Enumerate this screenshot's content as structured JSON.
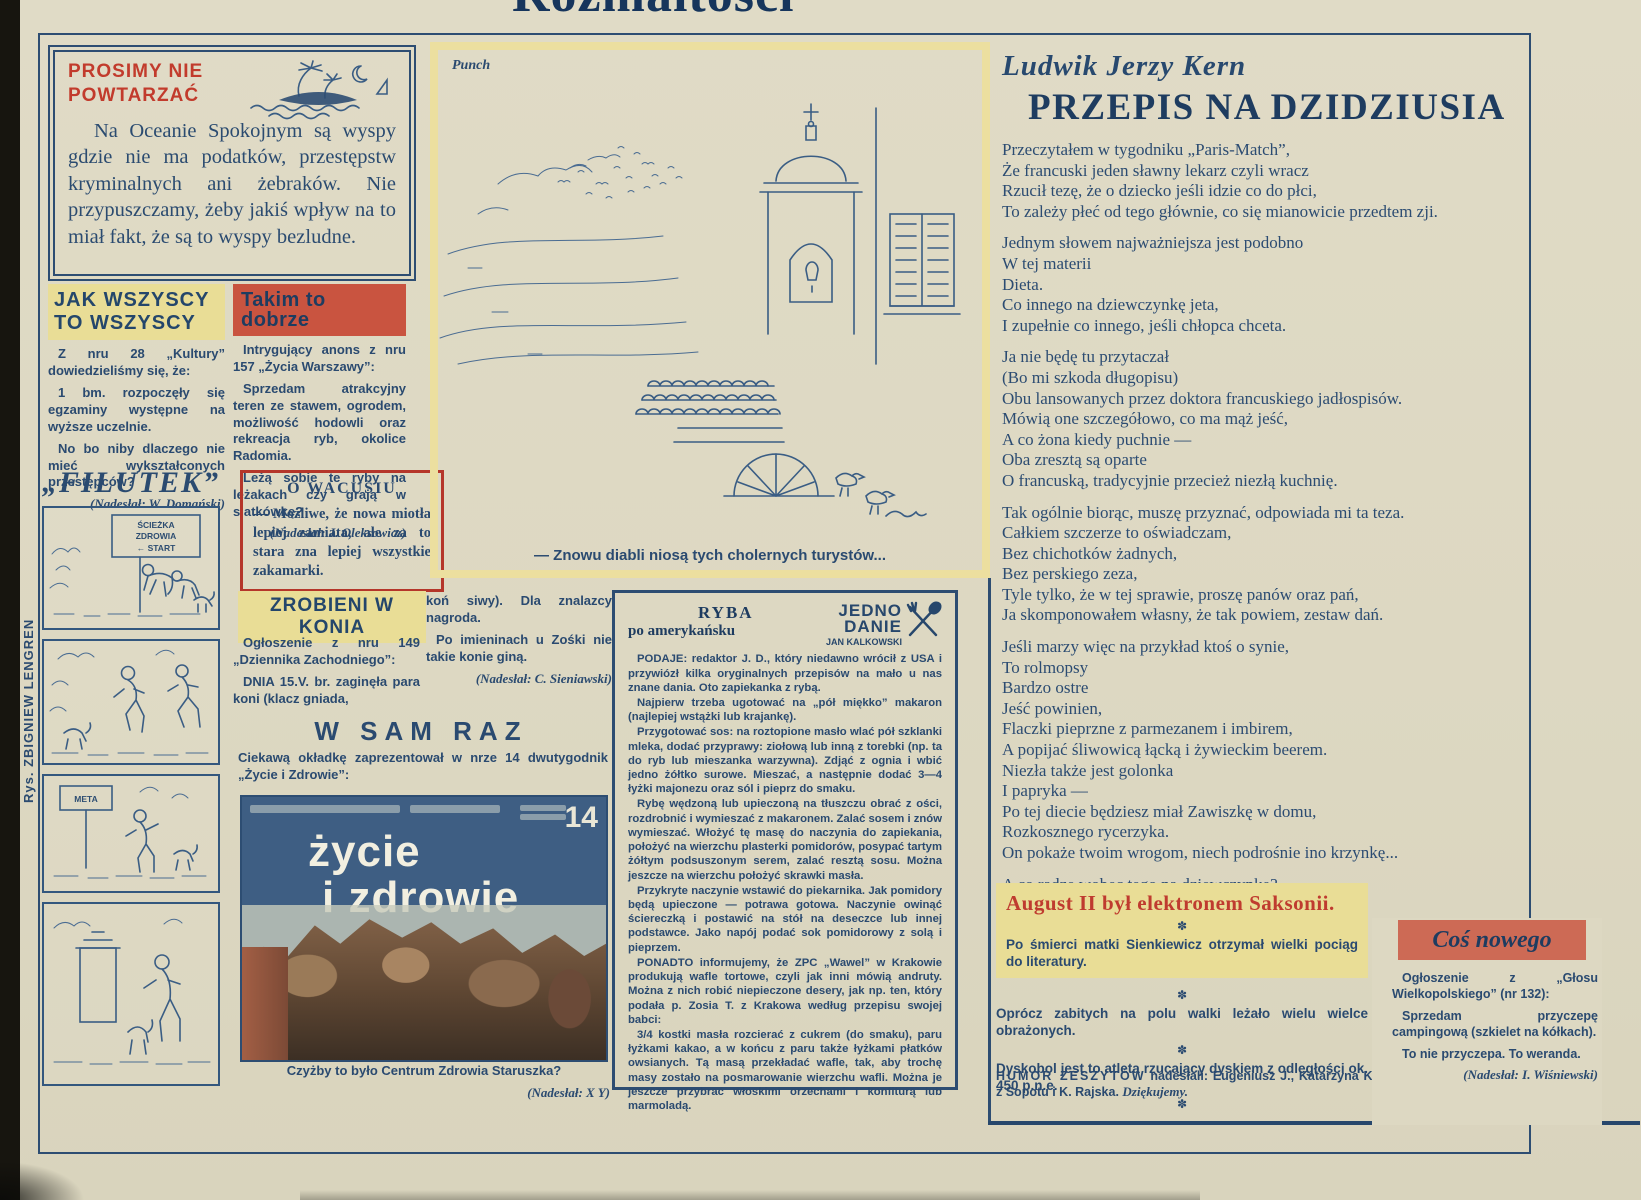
{
  "page": {
    "masthead": "Rozmaitości",
    "artist_credit": "Rys. ZBIGNIEW LENGREN"
  },
  "prosimy": {
    "title_line1": "PROSIMY NIE",
    "title_line2": "POWTARZAĆ",
    "body": "Na Oceanie Spokojnym są wyspy gdzie nie ma podatków, przestępstw kryminalnych ani żebraków. Nie przypuszczamy, żeby jakiś wpływ na to miał fakt, że są to wyspy bezludne."
  },
  "jak_wszyscy": {
    "title_line1": "JAK WSZYSCY",
    "title_line2": "TO WSZYSCY",
    "p1": "Z nru 28 „Kultury” dowiedzieliśmy się, że:",
    "p2": "1 bm. rozpoczęły się egzaminy występne na wyższe uczelnie.",
    "p3": "No bo niby dlaczego nie mieć wykształconych przestępców?",
    "credit": "(Nadesłał: W. Domański)"
  },
  "filutek": {
    "title": "„FILUTEK”",
    "sign_top": [
      "ŚCIEŻKA",
      "ZDROWIA",
      "← START"
    ],
    "sign_meta": "META"
  },
  "takim": {
    "title": "Takim to dobrze",
    "p1": "Intrygujący anons z nru 157 „Życia Warszawy”:",
    "p2": "Sprzedam atrakcyjny teren ze stawem, ogrodem, możliwość hodowli oraz rekreacja ryb, okolice Radomia.",
    "p3": "Leżą sobie te ryby na leżakach czy grają w siatkówkę?",
    "credit": "(Nadesłał: J. Oleksowicz)"
  },
  "wacusiu": {
    "title": "O WACUSIU",
    "body": "— Możliwe, że nowa miotła lepiej zamiata, ale za to stara zna lepiej wszystkie zakamarki."
  },
  "zrobieni": {
    "title": "ZROBIENI W KONIA",
    "col1_p1": "Ogłoszenie z nru 149 „Dziennika Zachodniego”:",
    "col1_p2": "DNIA 15.V. br. zaginęła para koni (klacz gniada,",
    "col2_p1": "koń siwy). Dla znalazcy nagroda.",
    "col2_p2": "Po imieninach u Zośki nie takie konie giną.",
    "credit": "(Nadesłał: C. Sieniawski)"
  },
  "wsamraz": {
    "title": "W SAM RAZ",
    "intro": "Ciekawą okładkę zaprezentował w nrze 14 dwutygodnik „Życie i Zdrowie”:",
    "cover_title_line1": "życie",
    "cover_title_line2": "i zdrowie",
    "cover_issue": "14",
    "caption": "Czyżby to było Centrum Zdrowia Staruszka?",
    "credit": "(Nadesłał: X Y)"
  },
  "punch": {
    "source": "Punch",
    "caption": "— Znowu diabli niosą tych cholernych turystów..."
  },
  "ryba": {
    "title_line1": "RYBA",
    "title_line2": "po amerykańsku",
    "logo_line1": "JEDNO",
    "logo_line2": "DANIE",
    "logo_line3": "JAN KALKOWSKI",
    "paragraphs": [
      "PODAJE: redaktor J. D., który niedawno wrócił z USA i przywiózł kilka oryginalnych przepisów na mało u nas znane dania. Oto zapiekanka z rybą.",
      "Najpierw trzeba ugotować na „pół miękko” makaron (najlepiej wstążki lub krajankę).",
      "Przygotować sos: na roztopione masło wlać pół szklanki mleka, dodać przyprawy: ziołową lub inną z torebki (np. ta do ryb lub mieszanka warzywna). Zdjąć z ognia i wbić jedno żółtko surowe. Mieszać, a następnie dodać 3—4 łyżki majonezu oraz sól i pieprz do smaku.",
      "Rybę wędzoną lub upieczoną na tłuszczu obrać z ości, rozdrobnić i wymieszać z makaronem. Zalać sosem i znów wymieszać. Włożyć tę masę do naczynia do zapiekania, położyć na wierzchu plasterki pomidorów, posypać tartym żółtym podsuszonym serem, zalać resztą sosu. Można jeszcze na wierzchu położyć skrawki masła.",
      "Przykryte naczynie wstawić do piekarnika. Jak pomidory będą upieczone — potrawa gotowa. Naczynie owinąć ściereczką i postawić na stół na deseczce lub innej podstawce. Jako napój podać sok pomidorowy z solą i pieprzem.",
      "PONADTO informujemy, że ZPC „Wawel” w Krakowie produkują wafle tortowe, czyli jak inni mówią andruty. Można z nich robić niepieczone desery, jak np. ten, który podała p. Zosia T. z Krakowa według przepisu swojej babci:",
      "3/4 kostki masła rozcierać z cukrem (do smaku), paru łyżkami kakao, a w końcu z paru także łyżkami płatków owsianych. Tą masą przekładać wafle, tak, aby trochę masy zostało na posmarowanie wierzchu wafli. Można je jeszcze przybrać włoskimi orzechami i konfiturą lub marmoladą."
    ]
  },
  "poem": {
    "author": "Ludwik Jerzy Kern",
    "title": "PRZEPIS NA DZIDZIUSIA",
    "stanzas": [
      [
        "Przeczytałem w tygodniku „Paris-Match”,",
        "Że francuski jeden sławny lekarz czyli wracz",
        "Rzucił tezę, że o dziecko jeśli idzie co do płci,",
        "To zależy płeć od tego głównie, co się mianowicie przedtem zji."
      ],
      [
        "Jednym słowem najważniejsza jest podobno",
        "W tej materii",
        "Dieta.",
        "Co innego na dziewczynkę jeta,",
        "I zupełnie co innego, jeśli chłopca chceta."
      ],
      [
        "Ja nie będę tu przytaczał",
        "(Bo mi szkoda długopisu)",
        "Obu lansowanych przez doktora francuskiego jadłospisów.",
        "Mówią one szczegółowo, co ma mąż jeść,",
        "A co żona kiedy puchnie —",
        "Oba zresztą są oparte",
        "O francuską, tradycyjnie przecież niezłą kuchnię."
      ],
      [
        "Tak ogólnie biorąc, muszę przyznać, odpowiada mi ta teza.",
        "Całkiem szczerze to oświadczam,",
        "Bez chichotków żadnych,",
        "Bez perskiego zeza,",
        "Tyle tylko, że w tej sprawie, proszę panów oraz pań,",
        "Ja skomponowałem własny, że tak powiem, zestaw dań."
      ],
      [
        "Jeśli marzy więc na przykład ktoś o synie,",
        "To rolmopsy",
        "Bardzo ostre",
        "Jeść powinien,",
        "Flaczki pieprzne z parmezanem i imbirem,",
        "A popijać śliwowicą łącką i żywieckim beerem.",
        "Niezła także jest golonka",
        "I papryka —",
        "Po tej diecie będziesz miał Zawiszkę w domu,",
        "Rozkosznego rycerzyka.",
        "On pokaże twoim wrogom, niech podrośnie ino krzynkę..."
      ],
      [
        "A co radzę wobec tego na dziewczynkę?",
        "Na dziewczynkę radzę pić Chanela piątkę",
        "I jeść szminkę."
      ]
    ]
  },
  "humor": {
    "heading": "August II był elektronem Saksonii.",
    "separator": "✽",
    "item1": "Po śmierci matki Sienkiewicz otrzymał wielki pociąg do literatury.",
    "item2": "Oprócz zabitych na polu walki leżało wielu wielce obrażonych.",
    "item3": "Dyskobol jest to atleta rzucający dyskiem z odległości ok. 450 p.n.e.",
    "footer_label": "HUMOR ZESZYTÓW",
    "footer_rest": " nadesłali: Eugeniusz J., Katarzyna K. z Sopotu i K. Rajska. ",
    "footer_thanks": "Dziękujemy."
  },
  "cos_nowego": {
    "title": "Coś nowego",
    "p1": "Ogłoszenie z „Głosu Wielkopolskiego” (nr 132):",
    "p2": "Sprzedam przyczepę campingową (szkielet na kółkach).",
    "p3": "To nie przyczepa. To weranda.",
    "credit": "(Nadesłał: I. Wiśniewski)"
  }
}
